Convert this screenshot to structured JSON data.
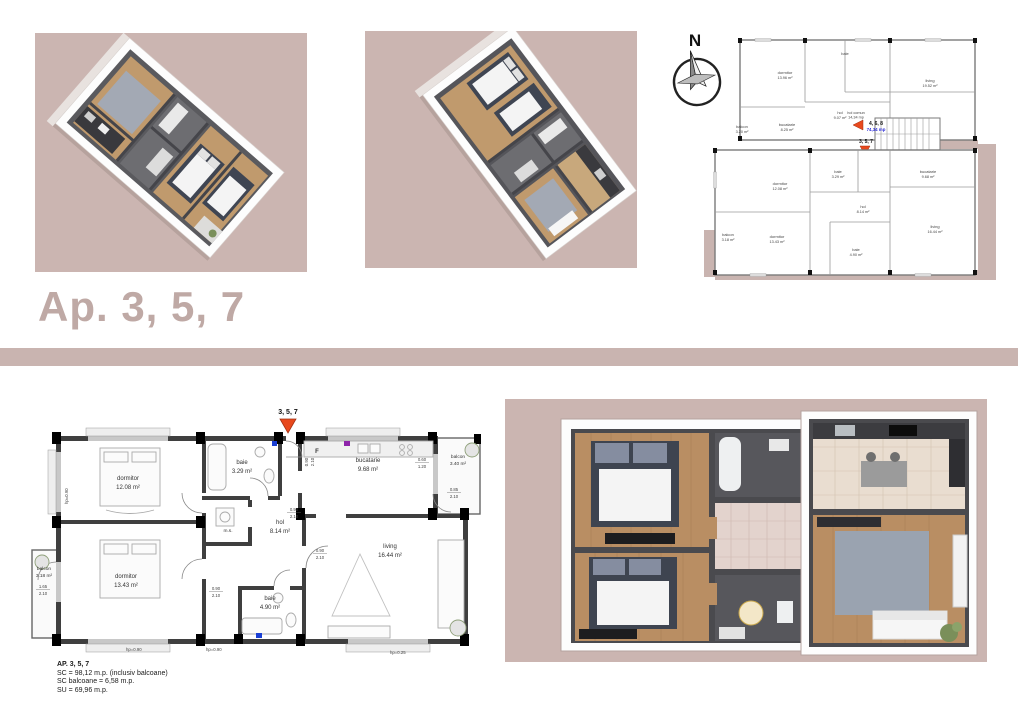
{
  "page": {
    "title": "Ap. 3, 5, 7",
    "colors": {
      "background": "#ffffff",
      "panel_mauve": "#cbb5b1",
      "divider_mauve": "#c9b4b0",
      "title_text": "#bfa9a5",
      "marker_red": "#e8491d",
      "area_blue": "#2b2bd6",
      "plan_line": "#3f3f3f",
      "wood_floor": "#c49a6c",
      "dark_wall_3d": "#4a4a4e",
      "rug_gray": "#9aa3b0"
    }
  },
  "compass": {
    "north_label": "N"
  },
  "site_plan": {
    "common_area": {
      "label": "hol comun",
      "area": "14,34 mp"
    },
    "unit_markers": [
      {
        "id": "4, 6, 8",
        "area": "74,34 mp"
      },
      {
        "id": "3, 5, 7",
        "area": "98,12 mp"
      }
    ],
    "upper_unit_rooms": [
      {
        "label": "dormitor",
        "area": "13.96 m²"
      },
      {
        "label": "baie",
        "area": ""
      },
      {
        "label": "living",
        "area": "19.52 m²"
      },
      {
        "label": "hol",
        "area": "9.07 m²"
      },
      {
        "label": "bucatarie",
        "area": "8.25 m²"
      },
      {
        "label": "balcon",
        "area": "3.20 m²"
      }
    ],
    "lower_unit_rooms": [
      {
        "label": "dormitor",
        "area": "12.08 m²"
      },
      {
        "label": "baie",
        "area": "3.29 m²"
      },
      {
        "label": "bucatarie",
        "area": "9.68 m²"
      },
      {
        "label": "hol",
        "area": "8.14 m²"
      },
      {
        "label": "dormitor",
        "area": "13.43 m²"
      },
      {
        "label": "baie",
        "area": "4.90 m²"
      },
      {
        "label": "living",
        "area": "16.44 m²"
      },
      {
        "label": "balcon",
        "area": "3.18 m²"
      }
    ]
  },
  "floor_plan": {
    "entrance_marker": "3, 5, 7",
    "fridge_label": "F",
    "rooms": [
      {
        "label": "dormitor",
        "area": "12.08 m²"
      },
      {
        "label": "baie",
        "area": "3.29 m²"
      },
      {
        "label": "bucatarie",
        "area": "9.68 m²"
      },
      {
        "label": "balcon",
        "area": "3.40 m²"
      },
      {
        "label": "hol",
        "area": "8.14 m²"
      },
      {
        "label": "m.s.",
        "area": ""
      },
      {
        "label": "dormitor",
        "area": "13.43 m²"
      },
      {
        "label": "balcon",
        "area": "3.18 m²"
      },
      {
        "label": "baie",
        "area": "4.90 m²"
      },
      {
        "label": "living",
        "area": "16.44 m²"
      }
    ],
    "door_dimensions": [
      {
        "w": "0.90",
        "h": "2.10"
      },
      {
        "w": "0.60",
        "h": "1.20"
      },
      {
        "w": "0.85",
        "h": "2.10"
      },
      {
        "w": "1.65",
        "h": "2.10"
      },
      {
        "w": "0.90",
        "h": "2.10"
      },
      {
        "w": "0.90",
        "h": "2.10"
      },
      {
        "w": "0.90",
        "h": "2.10"
      }
    ],
    "parapet_notes": [
      "hp=0.90",
      "hp=0.90",
      "hp=0.90",
      "hp=0.25"
    ]
  },
  "details": {
    "line1": "AP. 3, 5, 7",
    "line2": "SC = 98,12 m.p. (inclusiv balcoane)",
    "line3": "SC balcoane = 6,58 m.p.",
    "line4": "SU = 69,96 m.p."
  }
}
